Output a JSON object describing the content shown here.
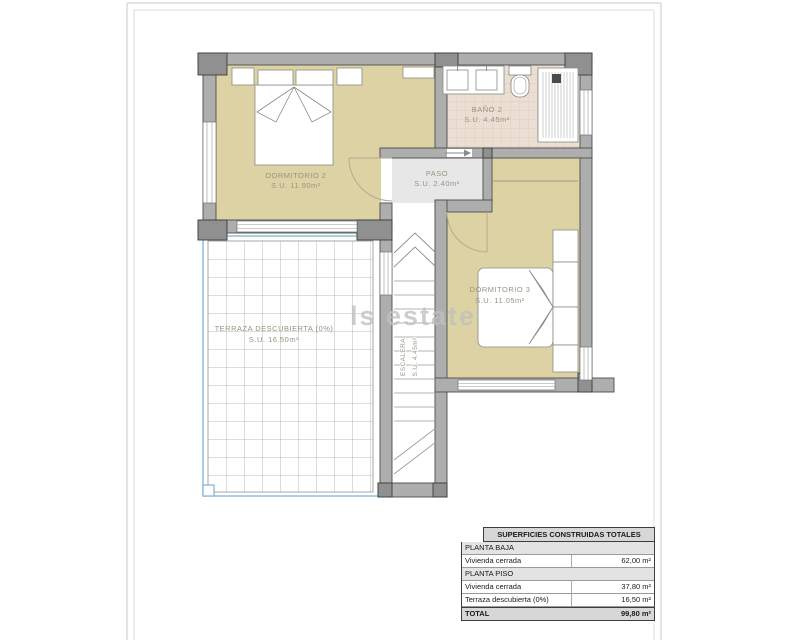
{
  "plan": {
    "watermark": "ls estate",
    "rooms": [
      {
        "name": "DORMITORIO 2",
        "area": "S.U. 11.90m²"
      },
      {
        "name": "BAÑO 2",
        "area": "S.U. 4.45m²"
      },
      {
        "name": "PASO",
        "area": "S.U. 2.40m²"
      },
      {
        "name": "DORMITORIO 3",
        "area": "S.U. 11.05m²"
      },
      {
        "name": "TERRAZA DESCUBIERTA (0%)",
        "area": "S.U. 16.50m²"
      },
      {
        "name": "ESCALERA",
        "area": "S.U. 4.45m²"
      }
    ],
    "colors": {
      "room_fill": "#dcd2a4",
      "bath_tile": "#eadfd2",
      "hall_fill": "#e7e7e7",
      "wall": "#aeaeae",
      "terrace_edge": "#7ab5d2",
      "label": "#9a9383"
    }
  },
  "table": {
    "title": "SUPERFICIES CONSTRUIDAS TOTALES",
    "rows": [
      {
        "type": "section",
        "label": "PLANTA BAJA",
        "value": ""
      },
      {
        "type": "data",
        "label": "Vivienda cerrada",
        "value": "62,00 m²"
      },
      {
        "type": "section",
        "label": "PLANTA PISO",
        "value": ""
      },
      {
        "type": "data",
        "label": "Vivienda cerrada",
        "value": "37,80 m²"
      },
      {
        "type": "data",
        "label": "Terraza descubierta (0%)",
        "value": "16,50 m²"
      },
      {
        "type": "total",
        "label": "TOTAL",
        "value": "99,80 m²"
      }
    ]
  }
}
